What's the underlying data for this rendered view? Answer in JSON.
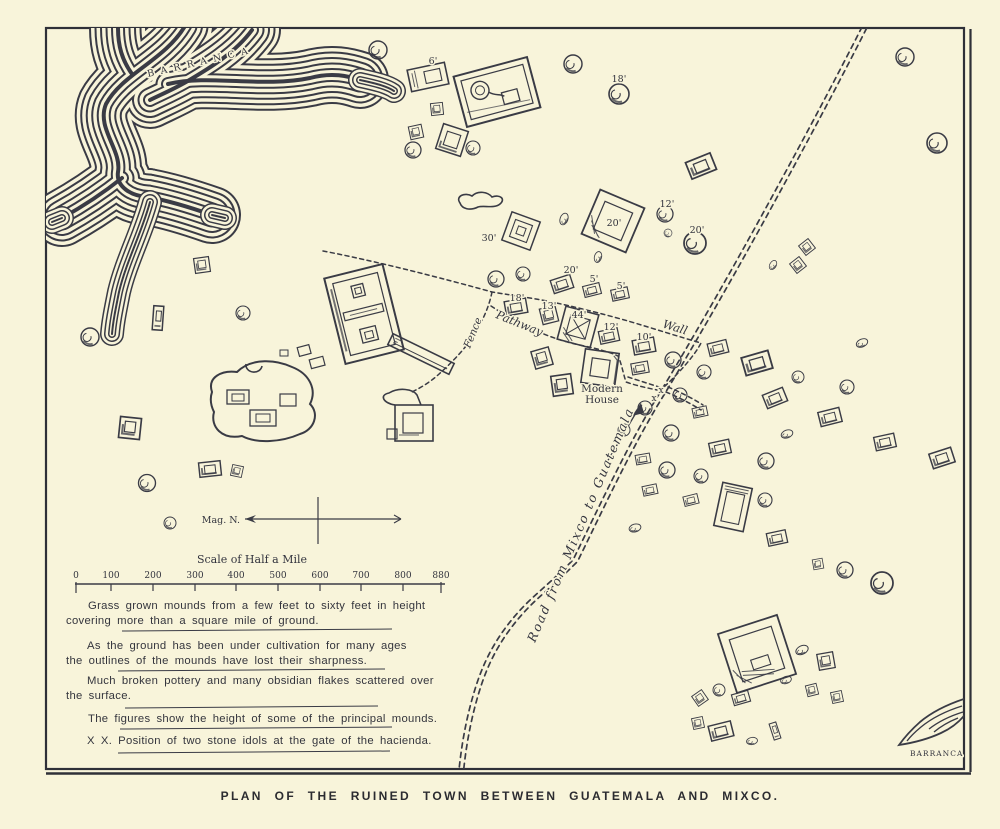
{
  "page": {
    "caption": "PLAN OF THE RUINED TOWN BETWEEN GUATEMALA AND MIXCO."
  },
  "map": {
    "colors": {
      "background": "#f8f4da",
      "ink": "#3a3b45",
      "caption": "#2b2b30"
    },
    "labels": {
      "barranca_top": "BARRANCA",
      "barranca_bottom": "BARRANCA",
      "fence": "Fence",
      "pathway": "Pathway",
      "wall": "Wall",
      "modern_house_line1": "Modern",
      "modern_house_line2": "House",
      "road": "Road from Mixco to Guatemala",
      "mag_n": "Mag. N.",
      "idol_mark_1": "x",
      "idol_mark_2": "x"
    },
    "heights": [
      "6'",
      "18'",
      "12'",
      "30'",
      "20'",
      "20'",
      "20'",
      "5'",
      "5'",
      "18'",
      "13'",
      "44'",
      "12'",
      "10'"
    ],
    "scale": {
      "title": "Scale of Half a Mile",
      "ticks": [
        "0",
        "100",
        "200",
        "300",
        "400",
        "500",
        "600",
        "700",
        "800",
        "880"
      ]
    },
    "notes": [
      {
        "line1": "Grass grown mounds from a few feet to sixty feet in height",
        "line2": "covering more than a square mile of ground."
      },
      {
        "line1": "As the ground has been under cultivation for many ages",
        "line2": "the outlines of the mounds have lost their sharpness."
      },
      {
        "line1": "Much broken pottery and many obsidian flakes scattered over",
        "line2": "the surface."
      },
      {
        "line1": "The figures show the height of some of the principal mounds.",
        "line2": ""
      },
      {
        "line1": "X X. Position of two stone idols at the gate of the hacienda.",
        "line2": ""
      }
    ]
  }
}
